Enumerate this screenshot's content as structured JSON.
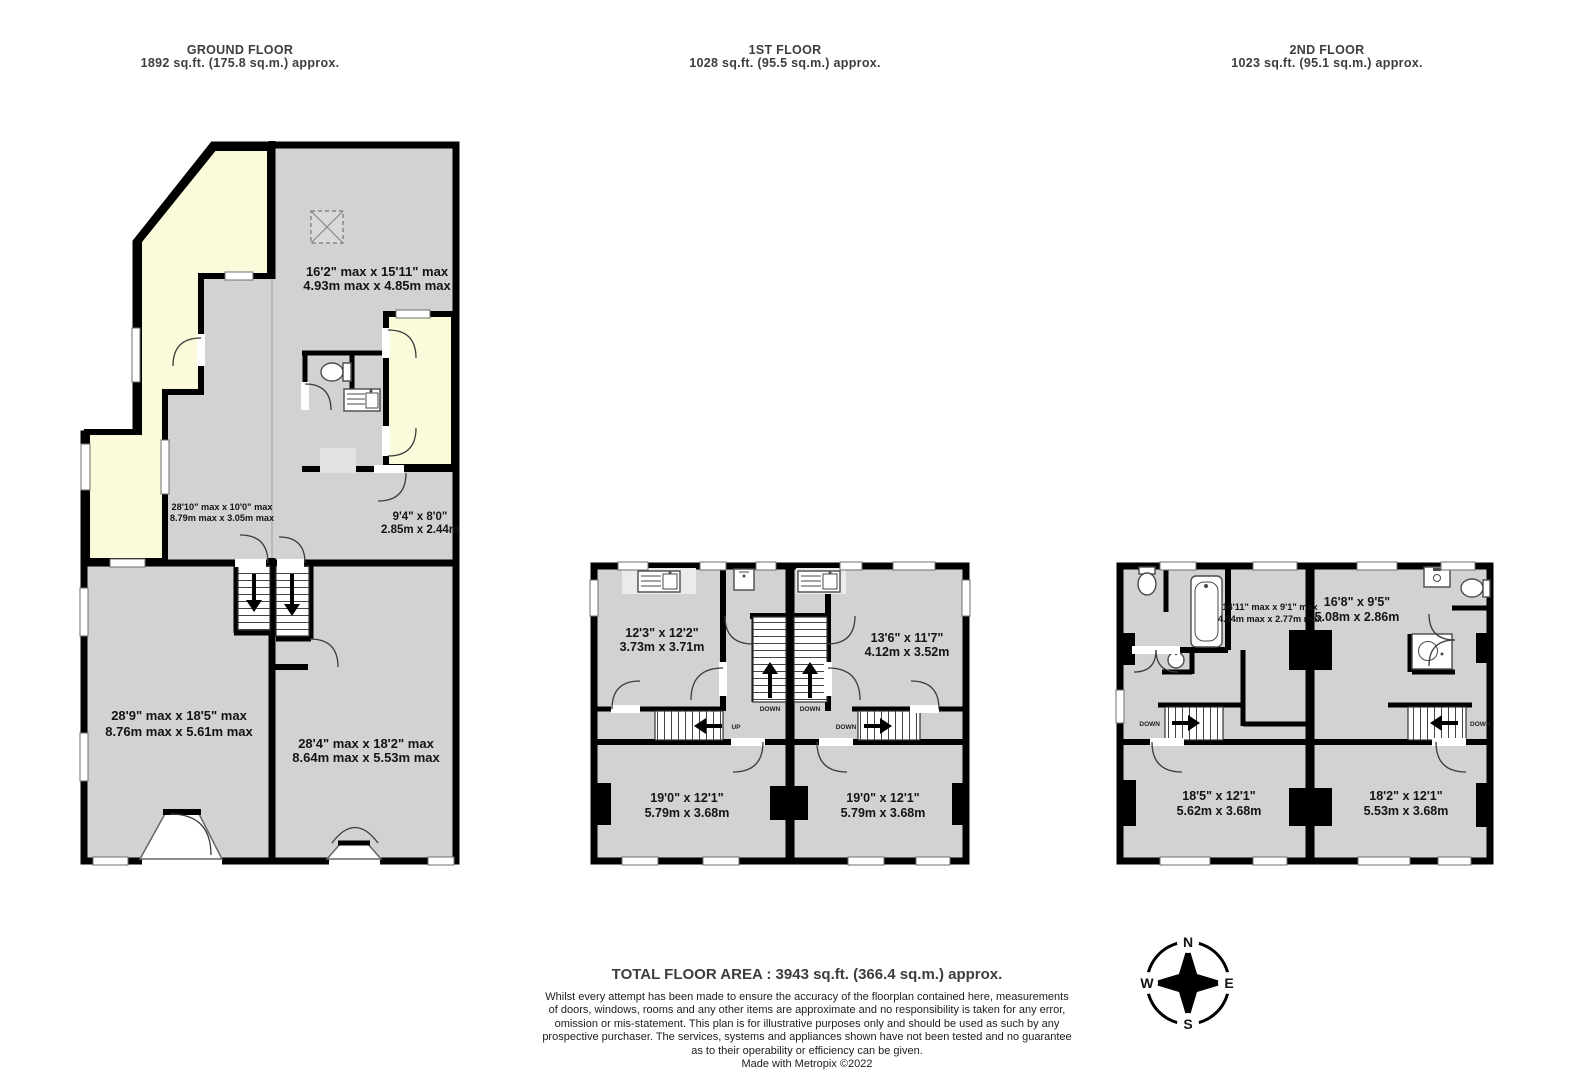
{
  "colors": {
    "room_fill": "#d2d2d2",
    "outdoor_fill": "#fbfbdc",
    "wall": "#000000",
    "header_text": "#3d3d3d",
    "label_text": "#141414"
  },
  "floors": [
    {
      "id": "ground",
      "title": "GROUND FLOOR",
      "area": "1892 sq.ft. (175.8 sq.m.) approx."
    },
    {
      "id": "first",
      "title": "1ST FLOOR",
      "area": "1028 sq.ft. (95.5 sq.m.) approx."
    },
    {
      "id": "second",
      "title": "2ND FLOOR",
      "area": "1023 sq.ft. (95.1 sq.m.) approx."
    }
  ],
  "rooms": {
    "gf_top_room": {
      "imperial": "16'2\" max x 15'11\" max",
      "metric": "4.93m max x 4.85m max"
    },
    "gf_hall": {
      "imperial": "28'10\" max x 10'0\" max",
      "metric": "8.79m max x 3.05m max"
    },
    "gf_rear_room": {
      "imperial": "9'4\"  x 8'0\"",
      "metric": "2.85m  x 2.44m"
    },
    "gf_left_room": {
      "imperial": "28'9\" max x 18'5\" max",
      "metric": "8.76m max x 5.61m max"
    },
    "gf_right_room": {
      "imperial": "28'4\" max x 18'2\" max",
      "metric": "8.64m max x 5.53m max"
    },
    "ff_top_left": {
      "imperial": "12'3\"  x 12'2\"",
      "metric": "3.73m  x 3.71m"
    },
    "ff_top_right": {
      "imperial": "13'6\"  x 11'7\"",
      "metric": "4.12m  x 3.52m"
    },
    "ff_bottom_left": {
      "imperial": "19'0\"  x 12'1\"",
      "metric": "5.79m  x 3.68m"
    },
    "ff_bottom_right": {
      "imperial": "19'0\"  x 12'1\"",
      "metric": "5.79m  x 3.68m"
    },
    "sf_bathroom": {
      "imperial": "14'11\" max x 9'1\" max",
      "metric": "4.54m max x 2.77m max"
    },
    "sf_top_right": {
      "imperial": "16'8\"  x 9'5\"",
      "metric": "5.08m  x 2.86m"
    },
    "sf_bottom_left": {
      "imperial": "18'5\"  x 12'1\"",
      "metric": "5.62m  x 3.68m"
    },
    "sf_bottom_right": {
      "imperial": "18'2\"  x 12'1\"",
      "metric": "5.53m  x 3.68m"
    }
  },
  "stairs": {
    "up": "UP",
    "down": "DOWN"
  },
  "compass": {
    "n": "N",
    "e": "E",
    "s": "S",
    "w": "W"
  },
  "footer": {
    "total": "TOTAL FLOOR AREA : 3943 sq.ft. (366.4 sq.m.) approx.",
    "disclaimer_lines": [
      "Whilst every attempt has been made to ensure the accuracy of the floorplan contained here, measurements",
      "of doors, windows, rooms and any other items are approximate and no responsibility is taken for any error,",
      "omission or mis-statement. This plan is for illustrative purposes only and should be used as such by any",
      "prospective purchaser. The services, systems and appliances shown have not been tested and no guarantee",
      "as to their operability or efficiency can be given."
    ],
    "credit": "Made with Metropix ©2022"
  }
}
